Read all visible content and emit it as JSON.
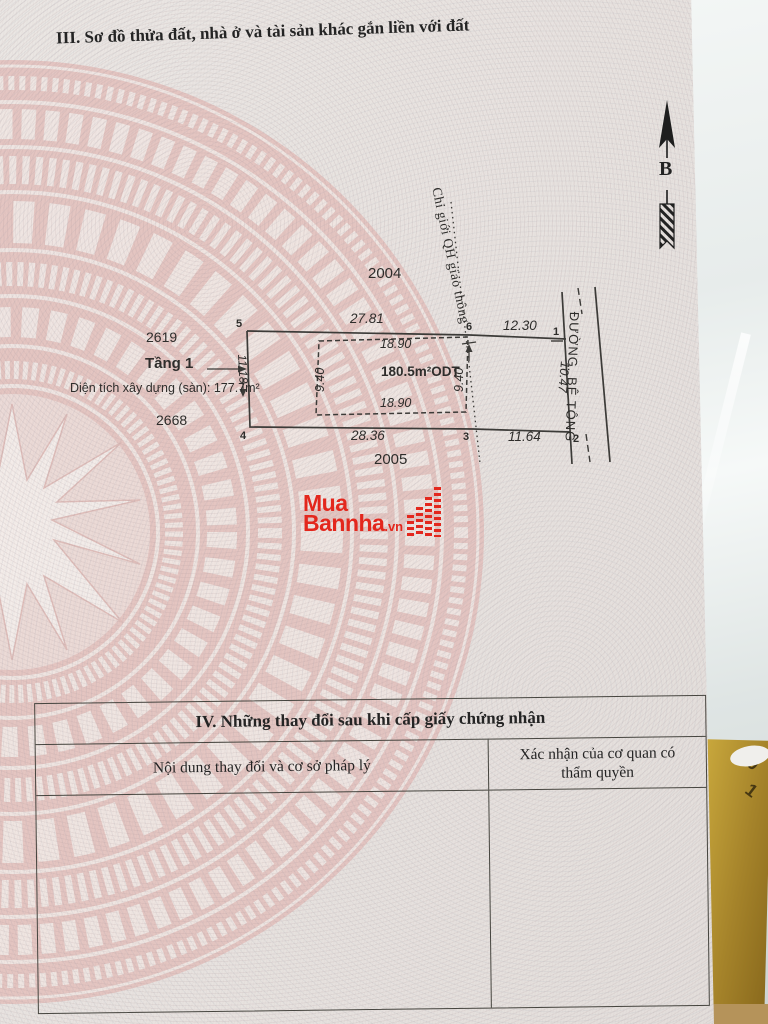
{
  "section3": {
    "title": "III. Sơ đồ thửa đất, nhà ở và tài sản khác gắn liền với đất",
    "compass_label": "B",
    "diagram": {
      "parcel_labels": {
        "top": "2004",
        "upper_left": "2619",
        "lower_left": "2668",
        "bottom": "2005"
      },
      "floor_label": "Tầng 1",
      "floor_area_label": "Diện tích xây dựng (sàn): 177.7m²",
      "area_label": "180.5m²ODT",
      "qh_line_label": "Chỉ giới QH giao thông",
      "road_label": "ĐƯỜNG. BÊ TÔNG",
      "corners": [
        "5",
        "6",
        "1",
        "4",
        "3",
        "2"
      ],
      "dimensions": {
        "top_left": "27.81",
        "top_right": "12.30",
        "bottom_left": "28.36",
        "bottom_right": "11.64",
        "left": "11.18",
        "right": "10.47",
        "inner_top": "18.90",
        "inner_bottom": "18.90",
        "inner_left": "9.40",
        "inner_right": "9.40"
      }
    },
    "watermark": {
      "line1": "Mua",
      "line2": "Bannha",
      "suffix": ".vn"
    }
  },
  "section4": {
    "title": "IV. Những thay đổi sau khi cấp giấy chứng nhận",
    "col1_header": "Nội dung thay đổi và cơ sở pháp lý",
    "col2_header": "Xác nhận của cơ quan có thẩm quyền"
  },
  "background": {
    "box_text_1": "10",
    "box_text_2": "1"
  }
}
